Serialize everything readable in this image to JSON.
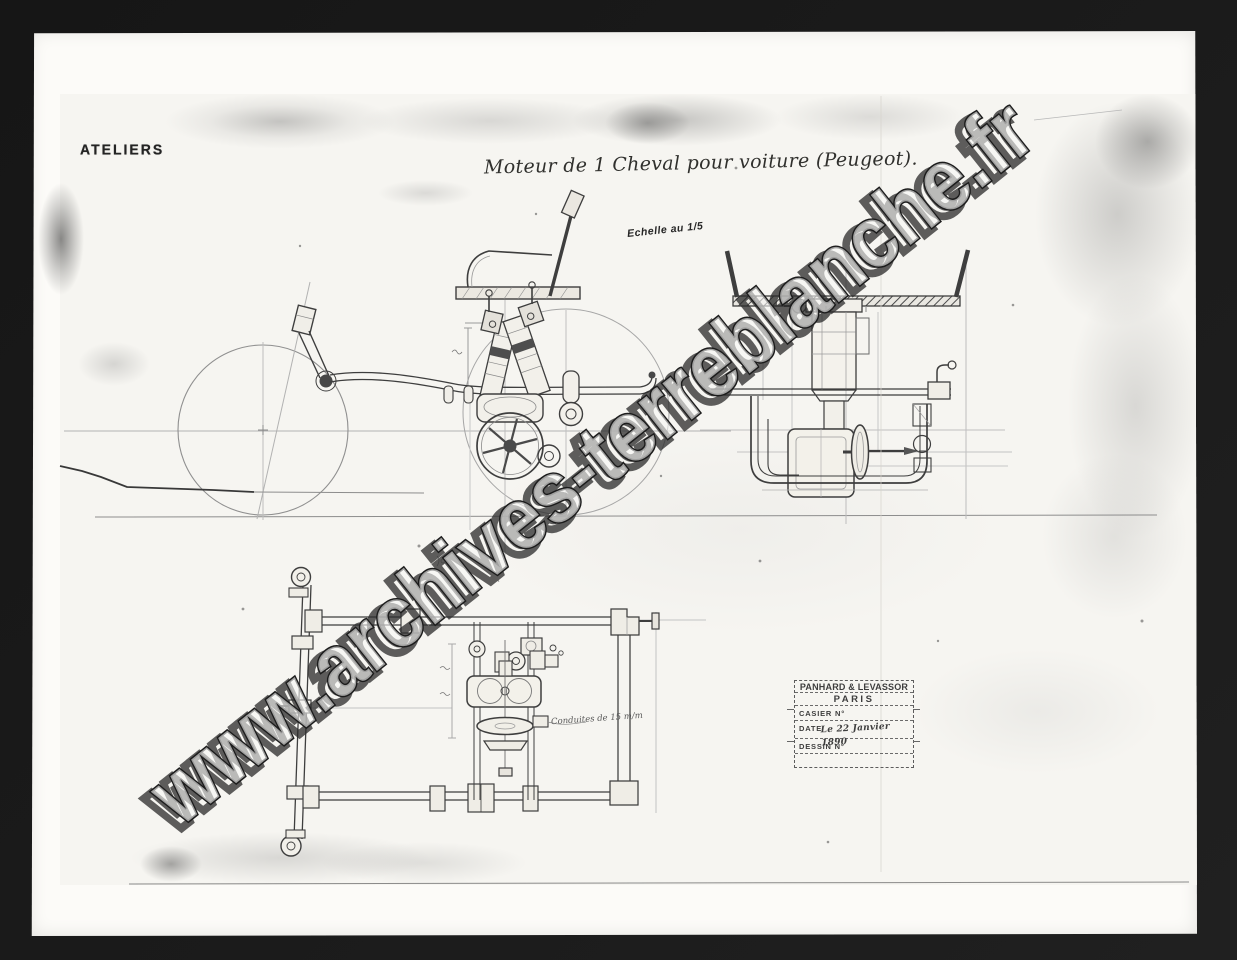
{
  "labels": {
    "workshop_stamp": "ATELIERS",
    "title": "Moteur de 1 Cheval pour voiture (Peugeot).",
    "scale": "Echelle au 1/5",
    "plan_note": "Conduites de 15 m/m"
  },
  "watermark": {
    "text": "www.archives-terreblanche.fr"
  },
  "title_block": {
    "company": "PANHARD & LEVASSOR",
    "city": "PARIS",
    "casier_label": "CASIER N°",
    "date_label": "DATE",
    "date_value": "Le 22 Janvier 1890",
    "dessin_label": "DESSIN N°"
  },
  "views": {
    "side": "side-elevation",
    "rear": "rear-elevation",
    "plan": "plan-view"
  },
  "colors": {
    "background": "#1a1a1a",
    "photo_paper": "#fcfbf8",
    "sheet_paper": "#f6f5f1",
    "ink_dark": "#3e3e3e",
    "ink_light": "#a9a9a9",
    "stamp_ink": "#3d3d3d"
  }
}
